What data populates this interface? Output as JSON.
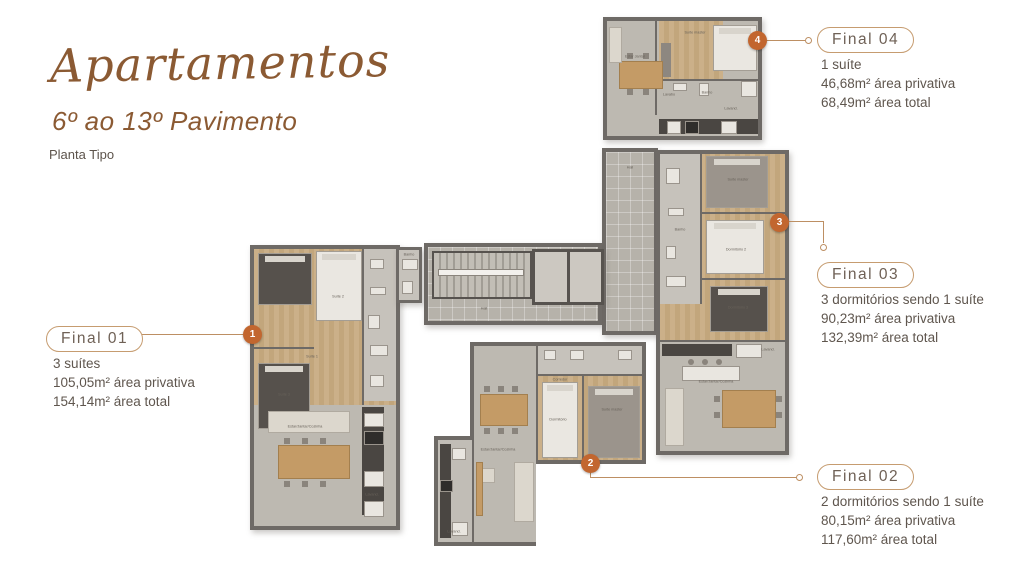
{
  "header": {
    "title": "Apartamentos",
    "subtitle": "6º ao 13º Pavimento",
    "note": "Planta Tipo"
  },
  "units": [
    {
      "name": "Final 01",
      "badge": "1",
      "features": [
        "3 suítes",
        "105,05m² área privativa",
        "154,14m² área total"
      ]
    },
    {
      "name": "Final 02",
      "badge": "2",
      "features": [
        "2 dormitórios sendo 1 suíte",
        "80,15m² área privativa",
        "117,60m² área total"
      ]
    },
    {
      "name": "Final 03",
      "badge": "3",
      "features": [
        "3 dormitórios sendo 1 suíte",
        "90,23m² área privativa",
        "132,39m² área total"
      ]
    },
    {
      "name": "Final 04",
      "badge": "4",
      "features": [
        "1 suíte",
        "46,68m² área privativa",
        "68,49m² área total"
      ]
    }
  ],
  "rooms": {
    "final01": [
      "Suíte 2",
      "Suíte 1",
      "Suíte 3",
      "Banho",
      "Estar/Jantar/Cozinha",
      "Lavand."
    ],
    "final02": [
      "Suíte master",
      "Dormitório",
      "Corredor",
      "Estar/Jantar/Cozinha",
      "Lavand."
    ],
    "final03": [
      "Suíte master",
      "Dormitório 2",
      "Dormitório 3",
      "Banho",
      "Estar/Jantar/Cozinha",
      "Lavand."
    ],
    "final04": [
      "Suíte master",
      "Estar Jantar",
      "Lavabo",
      "Banho",
      "Lavand."
    ],
    "core": [
      "Hall",
      "Hall"
    ]
  },
  "colors": {
    "accent_brown": "#8b5a33",
    "badge_orange": "#c2662f",
    "box_border": "#c69c70",
    "leader_line": "#bd8f63",
    "body_text": "#5f564e",
    "wall_gray": "#6e6a66",
    "floor_wood": "#c8ac82",
    "floor_gray": "#bdb9b1"
  }
}
